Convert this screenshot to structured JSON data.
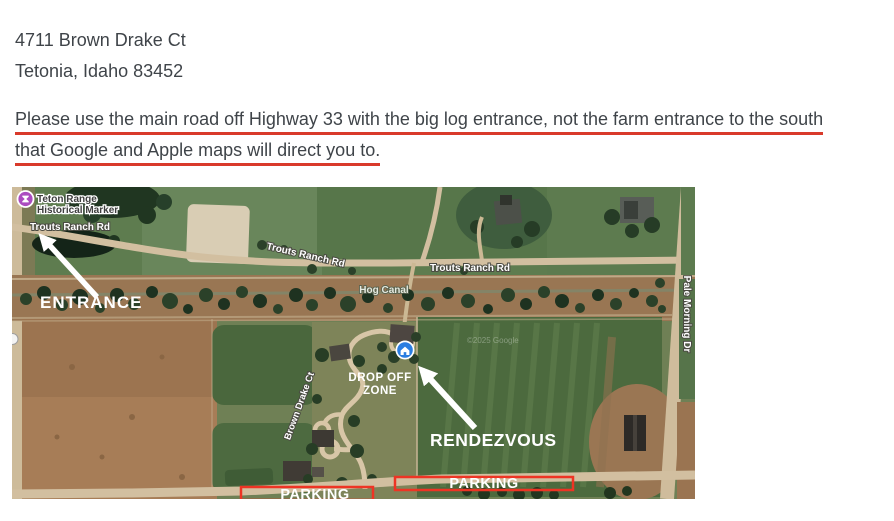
{
  "header": {
    "address_line1": "4711 Brown Drake Ct",
    "address_line2": "Tetonia, Idaho 83452",
    "notice_line1": "Please use the main road off Highway 33 with the big log entrance, not the farm entrance to the south",
    "notice_line2": "that Google and Apple maps will direct you to."
  },
  "map": {
    "poi": {
      "historical_marker_line1": "Teton Range",
      "historical_marker_line2": "Historical Marker"
    },
    "roads": {
      "trouts_ranch_rd_west": "Trouts Ranch Rd",
      "trouts_ranch_rd_mid": "Trouts Ranch Rd",
      "trouts_ranch_rd_east": "Trouts Ranch Rd",
      "hog_canal": "Hog Canal",
      "pale_morning_dr": "Pale Morning Dr",
      "brown_drake_ct": "Brown Drake Ct"
    },
    "annotations": {
      "entrance": "ENTRANCE",
      "drop_off_line1": "DROP OFF",
      "drop_off_line2": "ZONE",
      "rendezvous": "RENDEZVOUS",
      "parking_west": "PARKING",
      "parking_east": "PARKING"
    },
    "watermark": "©2025 Google"
  },
  "colors": {
    "body_text": "#3f4449",
    "notice_underline": "#d93a2b",
    "map_annotation_red": "#ee3424",
    "map_annotation_white": "#ffffff",
    "historical_marker_purple": "#ab4cc0",
    "home_marker_blue": "#2a7de1"
  }
}
